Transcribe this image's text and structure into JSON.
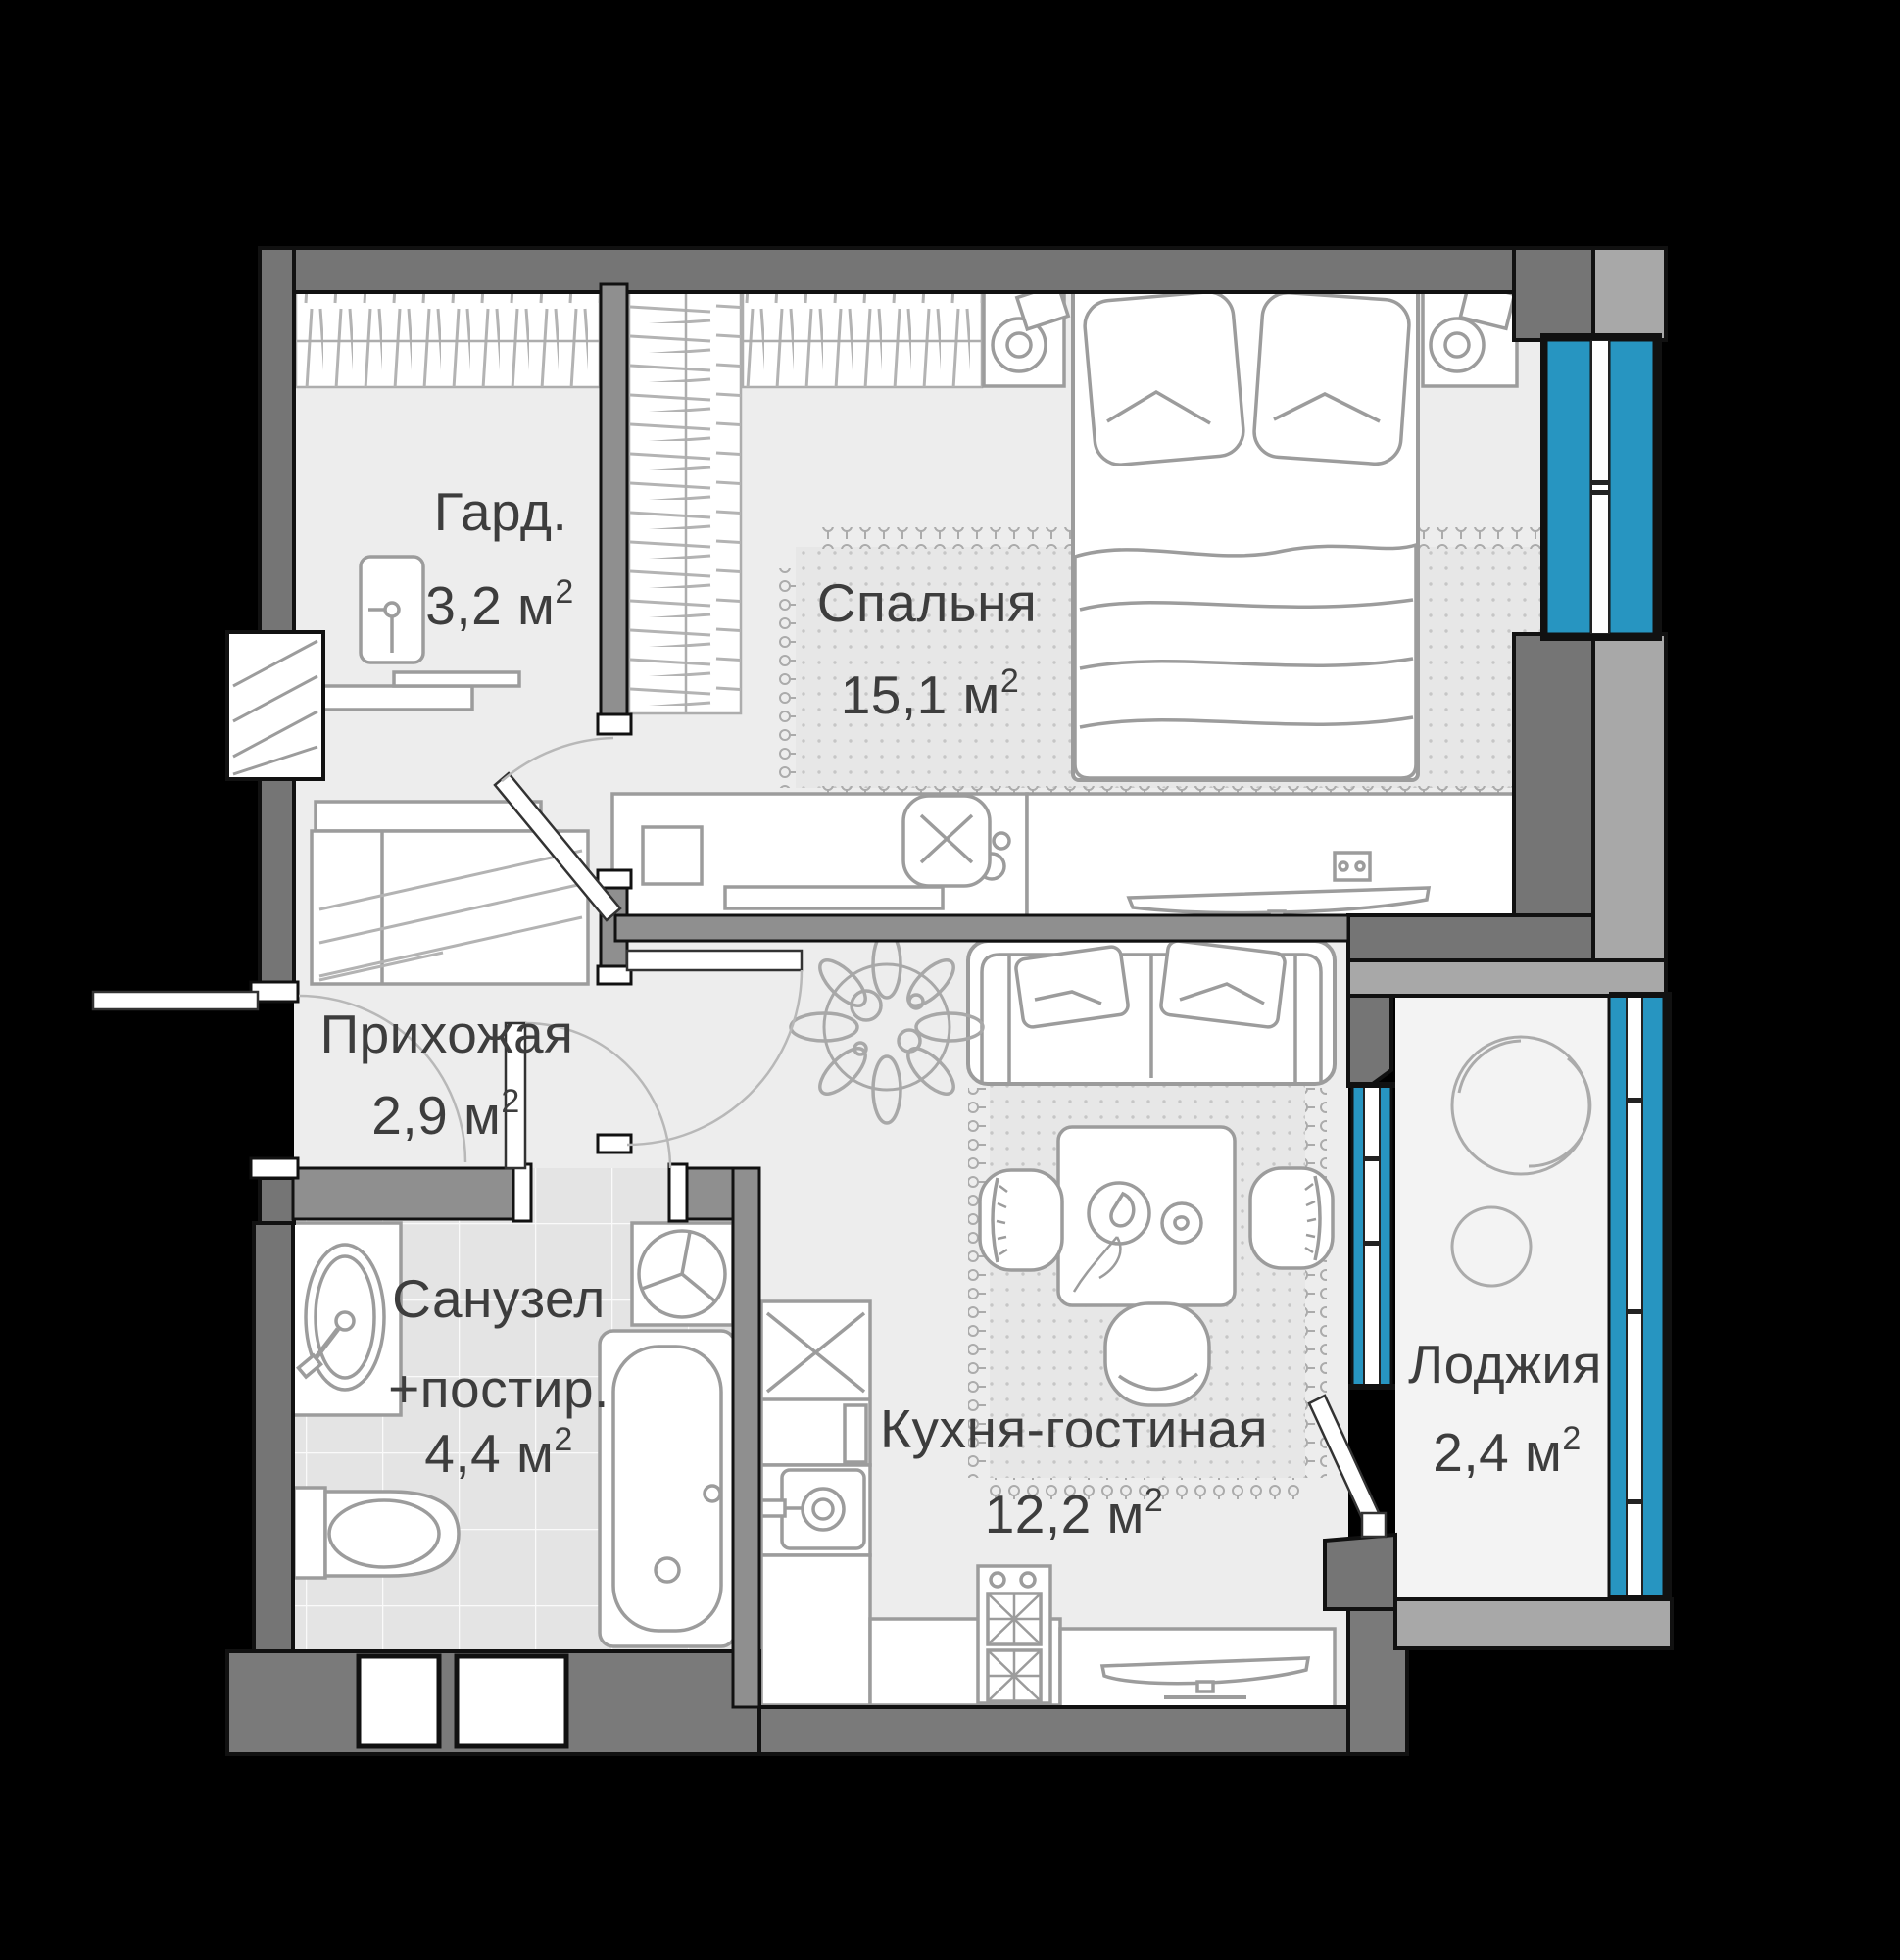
{
  "plan_title": "apartment-floor-plan",
  "superscript": "2",
  "rooms": [
    {
      "key": "garderob",
      "name": "Гард.",
      "area": "3,2 м"
    },
    {
      "key": "bedroom",
      "name": "Спальня",
      "area": "15,1 м"
    },
    {
      "key": "hallway",
      "name": "Прихожая",
      "area": "2,9 м"
    },
    {
      "key": "bathroom",
      "name": "Санузел",
      "name2": "+постир.",
      "area": "4,4 м"
    },
    {
      "key": "kitchen",
      "name": "Кухня-гостиная",
      "area": "12,2 м"
    },
    {
      "key": "loggia",
      "name": "Лоджия",
      "area": "2,4 м"
    }
  ],
  "colors": {
    "background": "#000000",
    "wall_dark": "#757575",
    "wall_mid": "#8f8f8f",
    "wall_light": "#a8a8a8",
    "floor": "#ededed",
    "floor_tile": "#e4e4e4",
    "carpet": "#e7e7e7",
    "window_glazing": "#2795c1",
    "furniture_stroke": "#9c9c9c",
    "text": "#3d3d3d"
  }
}
